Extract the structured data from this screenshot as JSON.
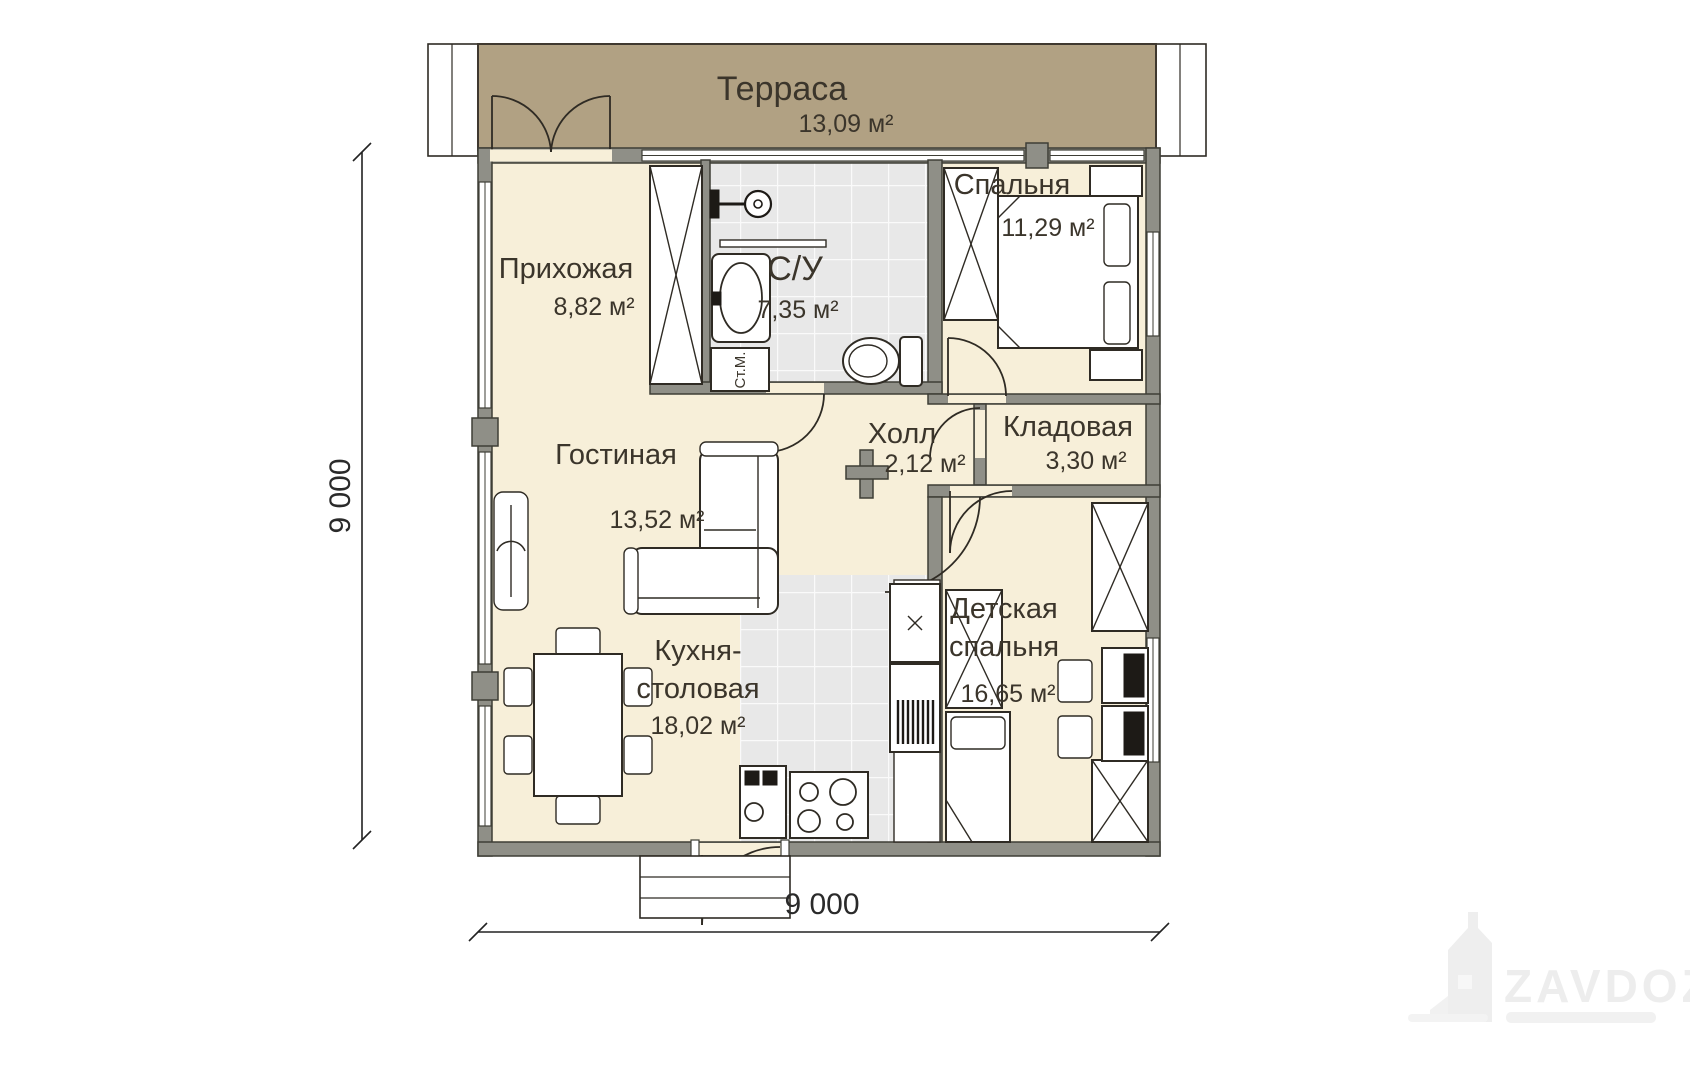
{
  "plan": {
    "rooms": [
      {
        "id": "terrace",
        "name": "Терраса",
        "area": "13,09 м²"
      },
      {
        "id": "hallway",
        "name": "Прихожая",
        "area": "8,82 м²"
      },
      {
        "id": "bathroom",
        "name": "С/У",
        "area": "7,35 м²"
      },
      {
        "id": "bedroom",
        "name": "Спальня",
        "area": "11,29 м²"
      },
      {
        "id": "hall",
        "name": "Холл",
        "area": "2,12 м²"
      },
      {
        "id": "storage",
        "name": "Кладовая",
        "area": "3,30 м²"
      },
      {
        "id": "living",
        "name": "Гостиная",
        "area": "13,52 м²"
      },
      {
        "id": "kitchen",
        "name": "Кухня-",
        "name2": "столовая",
        "area": "18,02 м²"
      },
      {
        "id": "kids",
        "name": "Детская",
        "name2": "спальня",
        "area": "16,65 м²"
      }
    ],
    "labels": {
      "washing_machine": "Ст.М."
    },
    "dimensions": {
      "width": "9 000",
      "height": "9 000"
    },
    "watermark": {
      "text": "ZAVDOZ"
    },
    "colors": {
      "room_fill": "#f7efd9",
      "terrace_fill": "#b1a183",
      "wall": "#8f8f87",
      "tile": "#e8e8e8",
      "line": "#2f2b24"
    }
  }
}
